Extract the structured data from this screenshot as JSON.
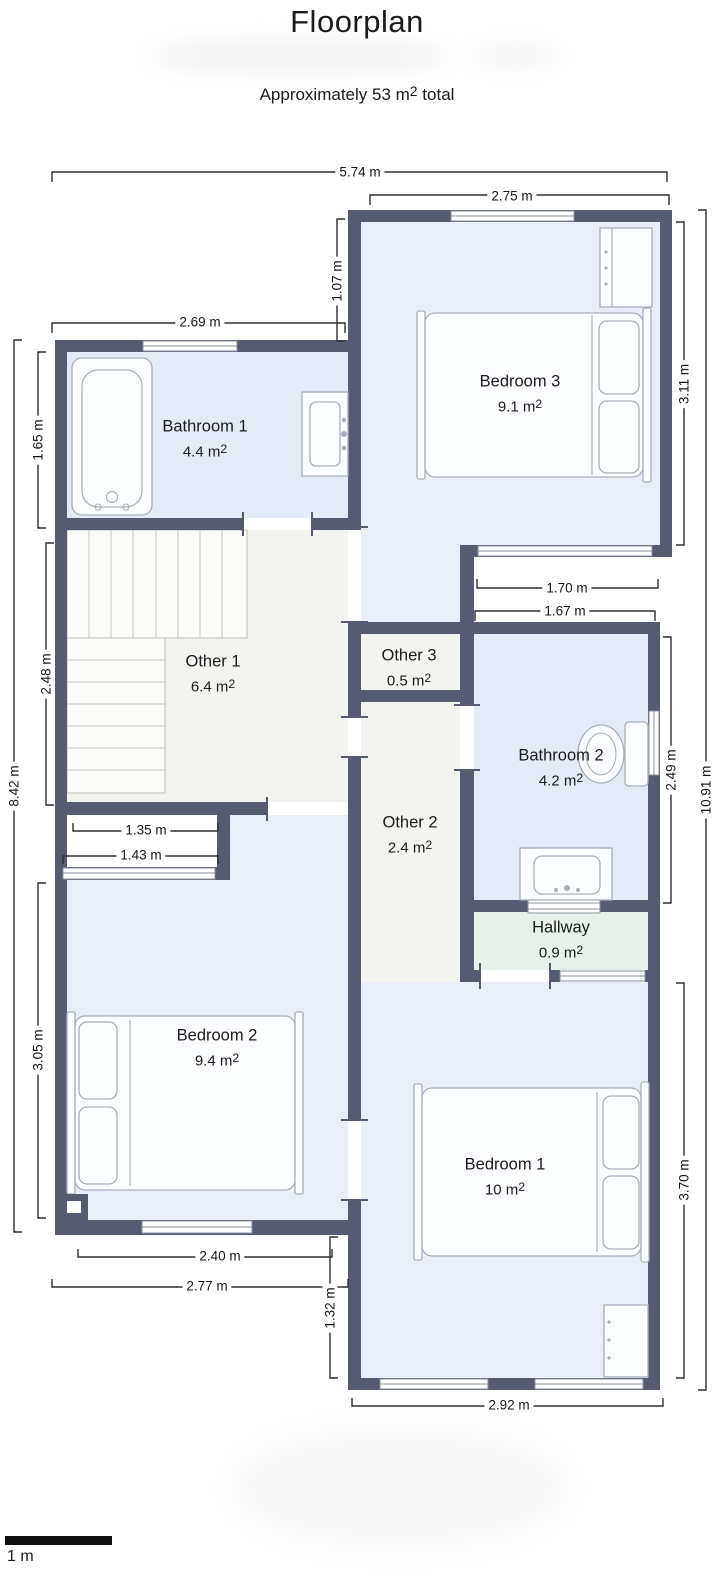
{
  "header": {
    "title": "Floorplan",
    "subtitle": "Approximately 53 m² total"
  },
  "scale_bar": {
    "label": "1 m"
  },
  "colors": {
    "wall": "#575b72",
    "bedroom_fill": "#e9eef8",
    "bathroom_fill": "#e4ebf7",
    "other_fill": "#f3f3f0",
    "hallway_fill": "#e7f1e9"
  },
  "rooms": [
    {
      "name": "Bedroom 3",
      "area": "9.1 m²"
    },
    {
      "name": "Bathroom 1",
      "area": "4.4 m²"
    },
    {
      "name": "Other 1",
      "area": "6.4 m²"
    },
    {
      "name": "Other 3",
      "area": "0.5 m²"
    },
    {
      "name": "Bathroom 2",
      "area": "4.2 m²"
    },
    {
      "name": "Other 2",
      "area": "2.4 m²"
    },
    {
      "name": "Hallway",
      "area": "0.9 m²"
    },
    {
      "name": "Bedroom 2",
      "area": "9.4 m²"
    },
    {
      "name": "Bedroom 1",
      "area": "10 m²"
    }
  ],
  "dimensions": [
    {
      "label": "5.74 m"
    },
    {
      "label": "2.75 m"
    },
    {
      "label": "2.69 m"
    },
    {
      "label": "1.07 m"
    },
    {
      "label": "3.11 m"
    },
    {
      "label": "1.65 m"
    },
    {
      "label": "2.48 m"
    },
    {
      "label": "8.42 m"
    },
    {
      "label": "1.70 m"
    },
    {
      "label": "1.67 m"
    },
    {
      "label": "2.49 m"
    },
    {
      "label": "10.91 m"
    },
    {
      "label": "1.35 m"
    },
    {
      "label": "1.43 m"
    },
    {
      "label": "3.05 m"
    },
    {
      "label": "3.70 m"
    },
    {
      "label": "2.40 m"
    },
    {
      "label": "2.77 m"
    },
    {
      "label": "1.32 m"
    },
    {
      "label": "2.92 m"
    }
  ]
}
